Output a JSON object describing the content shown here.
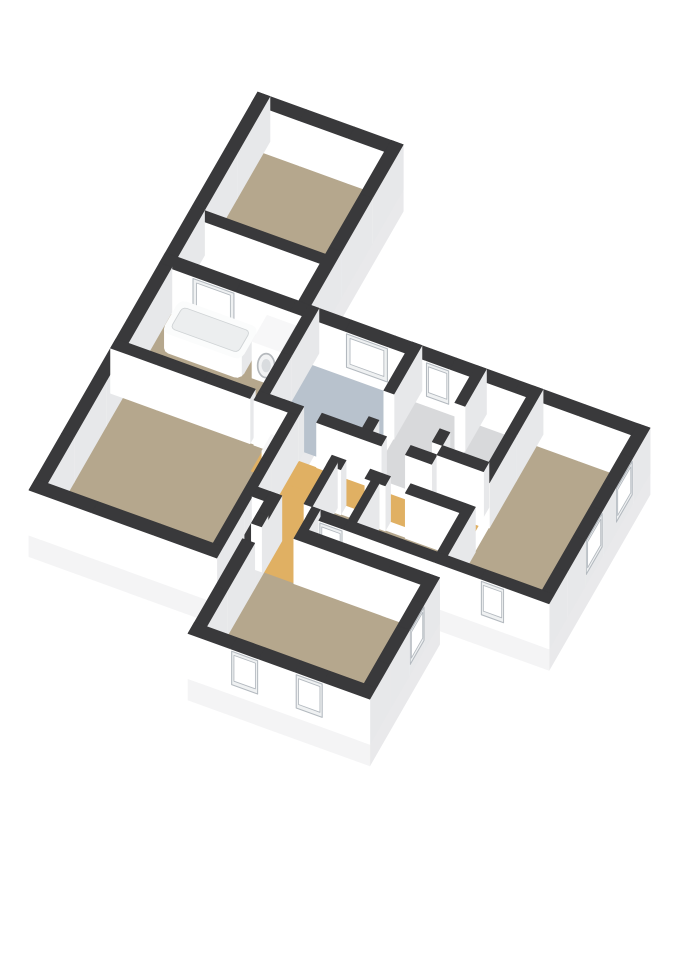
{
  "meta": {
    "title": "3D Floor Plan",
    "alt_text": "3D isometric cut-away floor plan rendering of an apartment with bedrooms, living room, bathroom with bathtub and washing machine, blue-floored room, orange corridor and white walls with dark tops"
  },
  "scene": {
    "background": "#ffffff",
    "colors": {
      "tan": "#b5a78d",
      "blue": "#b8c2cd",
      "orange": "#e0b063",
      "dark": "#2d2d30",
      "gray": "#d8d9db",
      "wall_top": "#39393b",
      "face_light": "#ffffff",
      "face_shade": "#e7e8ea",
      "slab_light": "#f4f4f5",
      "slab_shade": "#e9e9eb",
      "window_frame": "#eff1f2",
      "window_frame_edge": "#b3b9bf",
      "window_glass": "#ffffff",
      "tub_top": "#fbfcfc",
      "tub_inner": "#eceeef",
      "fixture_top": "#f7f7f8",
      "washer_ring": "#b5b9bd",
      "washer_ring_fill": "#f2f3f4",
      "washer_door": "#d9dcdf"
    },
    "render": {
      "ex": [
        0.94,
        0.34
      ],
      "ey": [
        -0.5,
        0.87
      ],
      "scale": 40,
      "wall_height": 42,
      "slab_depth": 20,
      "window_z": [
        9,
        40
      ],
      "max_seg": 1.6
    }
  },
  "slabs": [
    [
      0,
      0,
      3.6,
      4.6
    ],
    [
      0,
      4.3,
      4.65,
      10.65
    ],
    [
      3.55,
      4.3,
      12.0,
      9.0
    ],
    [
      4.95,
      9.3,
      9.45,
      12.55
    ],
    [
      5.0,
      8.7,
      6.2,
      9.6
    ]
  ],
  "rooms": [
    {
      "name": "bedroom-1",
      "rect": [
        0.3,
        0.3,
        3.3,
        3.05
      ],
      "color": "tan"
    },
    {
      "name": "light-shaft",
      "rect": [
        0.3,
        3.3,
        3.3,
        4.3
      ],
      "color": "dark"
    },
    {
      "name": "bathroom",
      "rect": [
        0.3,
        4.6,
        3.55,
        6.6
      ],
      "color": "tan"
    },
    {
      "name": "blue-room",
      "rect": [
        3.8,
        4.6,
        6.1,
        6.6
      ],
      "color": "blue"
    },
    {
      "name": "entrance-hall",
      "rect": [
        6.35,
        4.6,
        7.7,
        6.6
      ],
      "color": "gray"
    },
    {
      "name": "front-hall",
      "rect": [
        7.95,
        4.6,
        9.1,
        6.35
      ],
      "color": "gray"
    },
    {
      "name": "bedroom-2",
      "rect": [
        9.35,
        4.6,
        11.7,
        8.75
      ],
      "color": "tan"
    },
    {
      "name": "corridor",
      "rect": [
        3.8,
        6.85,
        9.1,
        7.45
      ],
      "color": "orange"
    },
    {
      "name": "corridor-branch",
      "rect": [
        4.65,
        7.45,
        5.8,
        8.75
      ],
      "color": "orange"
    },
    {
      "name": "toilet",
      "rect": [
        6.0,
        7.7,
        6.9,
        8.75
      ],
      "color": "tan"
    },
    {
      "name": "storage",
      "rect": [
        7.1,
        7.7,
        9.1,
        8.75
      ],
      "color": "tan"
    },
    {
      "name": "living-room",
      "rect": [
        0.3,
        6.85,
        4.4,
        10.35
      ],
      "color": "tan"
    },
    {
      "name": "connector",
      "rect": [
        5.25,
        8.75,
        6.0,
        9.6
      ],
      "color": "orange"
    },
    {
      "name": "bedroom-3",
      "rect": [
        5.25,
        9.6,
        9.15,
        12.25
      ],
      "color": "tan"
    }
  ],
  "walls": [
    [
      0,
      4.45,
      0.8,
      4.45,
      0.3,
      0
    ],
    [
      0.8,
      4.45,
      1.9,
      4.45,
      0.3,
      1
    ],
    [
      1.9,
      4.45,
      4.6,
      4.45,
      0.3,
      0
    ],
    [
      4.6,
      4.45,
      5.7,
      4.45,
      0.3,
      1
    ],
    [
      5.7,
      4.45,
      6.6,
      4.45,
      0.3,
      0
    ],
    [
      6.6,
      4.45,
      7.2,
      4.45,
      0.3,
      1
    ],
    [
      7.2,
      4.45,
      12.0,
      4.45,
      0.3,
      0
    ],
    [
      0.15,
      0,
      0.15,
      10.65,
      0.3,
      0
    ],
    [
      0,
      0.15,
      3.6,
      0.15,
      0.3,
      0
    ],
    [
      3.45,
      0,
      3.45,
      4.3,
      0.3,
      0
    ],
    [
      11.85,
      4.3,
      11.85,
      5.1,
      0.3,
      0
    ],
    [
      11.85,
      5.1,
      11.85,
      5.9,
      0.3,
      1
    ],
    [
      11.85,
      5.9,
      11.85,
      6.5,
      0.3,
      0
    ],
    [
      11.85,
      6.5,
      11.85,
      7.3,
      0.3,
      1
    ],
    [
      11.85,
      7.3,
      11.85,
      9.0,
      0.3,
      0
    ],
    [
      4.65,
      8.875,
      5.2,
      8.875,
      0.25,
      0
    ],
    [
      6.0,
      8.875,
      6.3,
      8.875,
      0.25,
      0
    ],
    [
      6.3,
      8.875,
      6.9,
      8.875,
      0.25,
      1
    ],
    [
      6.9,
      8.875,
      10.3,
      8.875,
      0.25,
      0
    ],
    [
      10.3,
      8.875,
      10.9,
      8.875,
      0.25,
      1
    ],
    [
      10.9,
      8.875,
      12.0,
      8.875,
      0.25,
      0
    ],
    [
      0,
      10.5,
      4.65,
      10.5,
      0.3,
      0
    ],
    [
      4.525,
      6.85,
      4.525,
      10.65,
      0.25,
      0
    ],
    [
      4.95,
      9.45,
      5.2,
      9.45,
      0.3,
      0
    ],
    [
      6.0,
      9.45,
      9.45,
      9.45,
      0.3,
      0
    ],
    [
      5.1,
      8.75,
      5.1,
      12.55,
      0.3,
      0
    ],
    [
      9.3,
      9.3,
      9.3,
      10.0,
      0.3,
      0
    ],
    [
      9.3,
      10.0,
      9.3,
      10.7,
      0.3,
      1
    ],
    [
      9.3,
      10.7,
      9.3,
      12.55,
      0.3,
      0
    ],
    [
      4.95,
      12.4,
      6.0,
      12.4,
      0.3,
      0
    ],
    [
      6.0,
      12.4,
      6.7,
      12.4,
      0.3,
      1
    ],
    [
      6.7,
      12.4,
      7.6,
      12.4,
      0.3,
      0
    ],
    [
      7.6,
      12.4,
      8.3,
      12.4,
      0.3,
      1
    ],
    [
      8.3,
      12.4,
      9.45,
      12.4,
      0.3,
      0
    ],
    [
      6.1,
      8.75,
      6.1,
      9.3,
      0.2,
      0
    ],
    [
      0.3,
      3.175,
      3.3,
      3.175,
      0.25,
      0
    ],
    [
      3.675,
      4.3,
      3.675,
      6.85,
      0.25,
      0
    ],
    [
      6.225,
      4.3,
      6.225,
      5.6,
      0.25,
      0
    ],
    [
      6.225,
      6.3,
      6.225,
      6.6,
      0.25,
      0
    ],
    [
      7.825,
      4.3,
      7.825,
      5.3,
      0.25,
      0
    ],
    [
      7.825,
      6.0,
      7.825,
      6.35,
      0.25,
      0
    ],
    [
      7.95,
      6.475,
      9.1,
      6.475,
      0.25,
      0
    ],
    [
      9.225,
      4.3,
      9.225,
      6.8,
      0.25,
      0
    ],
    [
      9.225,
      7.45,
      9.225,
      8.75,
      0.25,
      0
    ],
    [
      3.55,
      6.725,
      4.4,
      6.725,
      0.25,
      0
    ],
    [
      5.1,
      6.725,
      6.7,
      6.725,
      0.25,
      0
    ],
    [
      7.3,
      6.725,
      7.95,
      6.725,
      0.25,
      0
    ],
    [
      0,
      6.725,
      3.45,
      6.725,
      0.25,
      0
    ],
    [
      4.15,
      6.725,
      4.65,
      6.725,
      0.25,
      0
    ],
    [
      5.8,
      7.575,
      6.15,
      7.575,
      0.25,
      0
    ],
    [
      6.75,
      7.575,
      7.25,
      7.575,
      0.25,
      0
    ],
    [
      7.75,
      7.575,
      9.1,
      7.575,
      0.25,
      0
    ],
    [
      5.9,
      7.575,
      5.9,
      8.75,
      0.2,
      0
    ],
    [
      7.0,
      7.7,
      7.0,
      8.75,
      0.2,
      0
    ]
  ],
  "fixtures": [
    {
      "type": "tub",
      "name": "bathtub",
      "rect": [
        0.55,
        4.65,
        2.5,
        5.5
      ],
      "h": 18
    },
    {
      "type": "washer",
      "name": "washing-machine",
      "rect": [
        2.72,
        4.68,
        3.42,
        5.38
      ],
      "h": 34
    },
    {
      "type": "box",
      "name": "boiler-unit",
      "rect": [
        4.06,
        7.0,
        4.42,
        7.44
      ],
      "h": 22
    }
  ]
}
